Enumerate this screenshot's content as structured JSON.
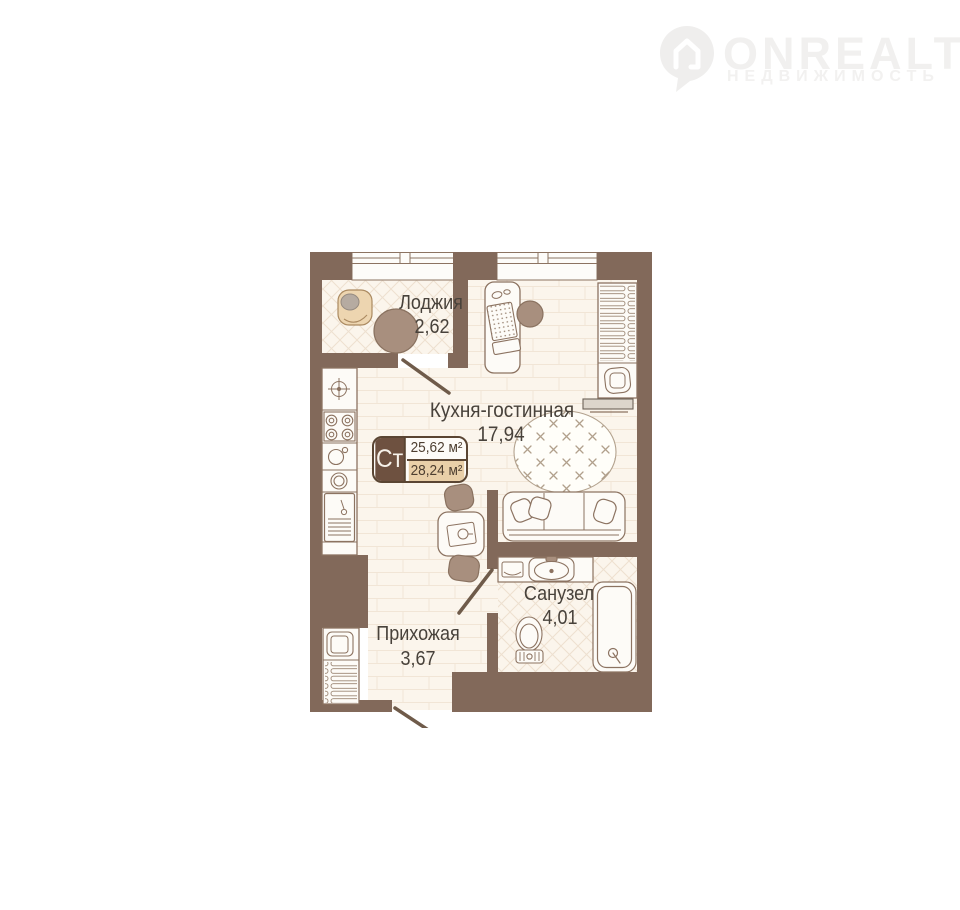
{
  "logo": {
    "brand": "ONREALT",
    "subtitle": "НЕДВИЖИМОСТЬ"
  },
  "plan": {
    "type_badge": {
      "type_label": "Ст",
      "area_total": "25,62 м²",
      "area_with_balcony": "28,24 м²"
    },
    "rooms": [
      {
        "name": "Лоджия",
        "area": "2,62"
      },
      {
        "name": "Кухня-гостинная",
        "area": "17,94"
      },
      {
        "name": "Санузел",
        "area": "4,01"
      },
      {
        "name": "Прихожая",
        "area": "3,67"
      }
    ],
    "colors": {
      "wall": "#82695a",
      "floor": "#fbf5ec",
      "floor_line": "#f1e5d6",
      "accent_tan": "#e9cfa8",
      "badge_brown": "#6e5140",
      "badge_border": "#5a4533",
      "furniture_outline": "#8c7361",
      "furniture_brown": "#a88f7e",
      "label_text": "#48423b",
      "watermark": "#f1f0ef"
    }
  }
}
